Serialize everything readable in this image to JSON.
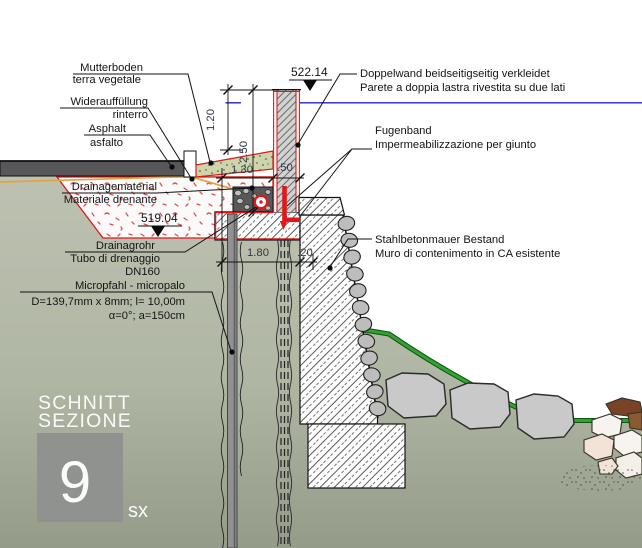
{
  "title_block": {
    "line1": "SCHNITT",
    "line2": "SEZIONE",
    "number": "9",
    "suffix": "sx"
  },
  "labels": {
    "mutterboden_de": "Mutterboden",
    "mutterboden_it": "terra vegetale",
    "wiederauffuellung_de": "Widerauffüllung",
    "wiederauffuellung_it": "rinterro",
    "asphalt_de": "Asphalt",
    "asphalt_it": "asfalto",
    "drainagematerial_de": "Drainagematerial",
    "drainagematerial_it": "Materiale drenante",
    "drainagrohr_de": "Drainagrohr",
    "drainagrohr_it": "Tubo di drenaggio",
    "drainagrohr_size": "DN160",
    "micropfahl": "Micropfahl - micropalo",
    "micropfahl_spec1": "D=139,7mm x 8mm; l= 10,00m",
    "micropfahl_spec2": "α=0°; a=150cm",
    "doppelwand_de": "Doppelwand beidseitigseitig verkleidet",
    "doppelwand_it": "Parete a doppia lastra rivestita su due lati",
    "fugenband_de": "Fugenband",
    "fugenband_it": "Impermeabilizzazione per giunto",
    "stahlbetonmauer_de": "Stahlbetonmauer Bestand",
    "stahlbetonmauer_it": "Muro di contenimento in CA esistente"
  },
  "levels": {
    "upper": "522.14",
    "lower": "519.04"
  },
  "dimensions": {
    "d120": "1.20",
    "d250": "2.50",
    "d130": "1.30",
    "d050": ".50",
    "d180": "1.80",
    "d020": ".20"
  },
  "colors": {
    "terrain": "#b4baa8",
    "terrain_dark": "#959b89",
    "asphalt": "#57575a",
    "red_line": "#e01818",
    "blue_line": "#2222cc",
    "green_slope": "#2fa52f",
    "orange_line": "#e6a23c",
    "wall_gray": "#d2d2d2",
    "stone_gray": "#bdbdbd",
    "title_box": "#909290"
  }
}
